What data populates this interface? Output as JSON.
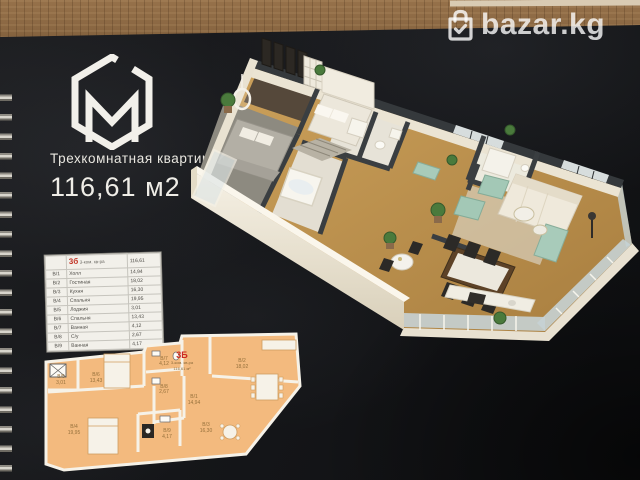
{
  "watermark": {
    "label": "bazar.kg",
    "icon": "shopping-bag-check-icon"
  },
  "brochure": {
    "logo_letter": "M",
    "title": "Трехкомнатная квартира",
    "area_label": "116,61 м2",
    "area_table": {
      "unit_code": "3б",
      "unit_type": "3-ком. кв-ра",
      "total_area": "116,61",
      "rows": [
        {
          "code": "В/1",
          "name": "Холл",
          "area": "14,94"
        },
        {
          "code": "В/2",
          "name": "Гостиная",
          "area": "18,02"
        },
        {
          "code": "В/3",
          "name": "Кухня",
          "area": "16,30"
        },
        {
          "code": "В/4",
          "name": "Спальня",
          "area": "19,95"
        },
        {
          "code": "В/5",
          "name": "Лоджия",
          "area": "3,01"
        },
        {
          "code": "В/6",
          "name": "Спальня",
          "area": "13,43"
        },
        {
          "code": "В/7",
          "name": "Ванная",
          "area": "4,12"
        },
        {
          "code": "В/8",
          "name": "С/у",
          "area": "2,67"
        },
        {
          "code": "В/9",
          "name": "Ванная",
          "area": "4,17"
        }
      ]
    },
    "plan2d": {
      "unit_code": "3Б",
      "unit_type": "3-ком. кв-ра",
      "unit_area": "116,61 м²",
      "rooms": [
        {
          "code": "В/5",
          "area": "3,01"
        },
        {
          "code": "В/6",
          "area": "13,43"
        },
        {
          "code": "В/7",
          "area": "4,12"
        },
        {
          "code": "В/8",
          "area": "2,67"
        },
        {
          "code": "В/1",
          "area": "14,94"
        },
        {
          "code": "В/2",
          "area": "18,02"
        },
        {
          "code": "В/3",
          "area": "16,30"
        },
        {
          "code": "В/4",
          "area": "19,95"
        },
        {
          "code": "В/9",
          "area": "4,17"
        }
      ]
    },
    "colors": {
      "accent_red": "#c23325",
      "plan_fill": "#f3ba7e",
      "page": "#141518"
    }
  }
}
